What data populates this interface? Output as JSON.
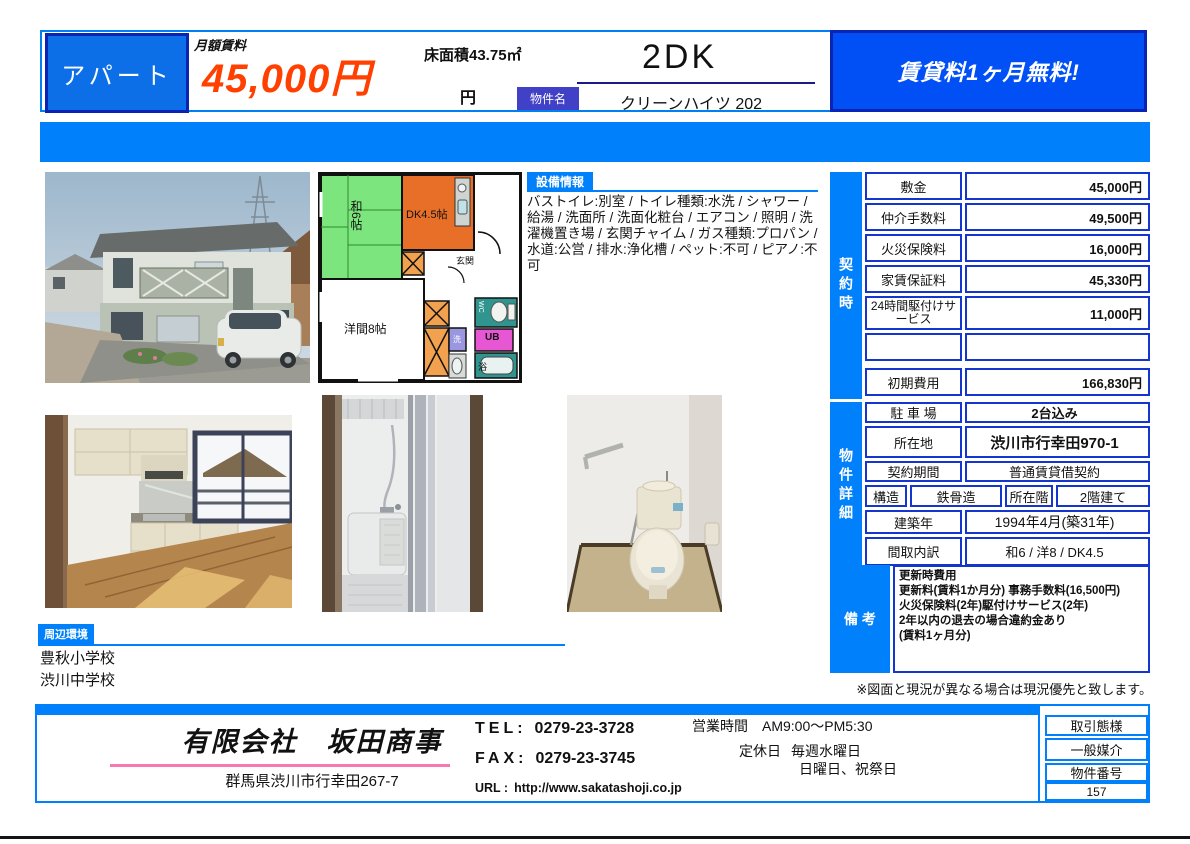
{
  "header": {
    "property_type": "アパート",
    "rent_label": "月額賃料",
    "rent_value": "45,000円",
    "floor_area": "床面積43.75㎡",
    "yen": "円",
    "layout": "2DK",
    "name_label": "物件名",
    "property_name": "クリーンハイツ 202",
    "promo": "賃貸料1ヶ月無料!"
  },
  "equipment": {
    "tab": "設備情報",
    "text": "バストイレ:別室 / トイレ種類:水洗 / シャワー / 給湯 / 洗面所 / 洗面化粧台 / エアコン / 照明 / 洗濯機置き場 / 玄関チャイム / ガス種類:プロパン / 水道:公営 / 排水:浄化槽 / ペット:不可 / ピアノ:不可"
  },
  "contract": {
    "side_label": "契約時",
    "rows": [
      {
        "label": "敷金",
        "value": "45,000円"
      },
      {
        "label": "仲介手数料",
        "value": "49,500円"
      },
      {
        "label": "火災保険料",
        "value": "16,000円"
      },
      {
        "label": "家賃保証料",
        "value": "45,330円"
      },
      {
        "label": "24時間駆付けサービス",
        "value": "11,000円"
      },
      {
        "label": "",
        "value": ""
      },
      {
        "label": "初期費用",
        "value": "166,830円"
      }
    ]
  },
  "details": {
    "side_label": "物件詳細",
    "parking_label": "駐 車 場",
    "parking": "2台込み",
    "location_label": "所在地",
    "location": "渋川市行幸田970-1",
    "term_label": "契約期間",
    "term": "普通賃貸借契約",
    "structure_label": "構造",
    "structure": "鉄骨造",
    "floor_label": "所在階",
    "floor": "2階建て",
    "built_label": "建築年",
    "built": "1994年4月(築31年)",
    "layout_label": "間取内訳",
    "layout": "和6 / 洋8 / DK4.5"
  },
  "remarks": {
    "side_label": "備 考",
    "lines": [
      "更新時費用",
      "更新料(賃料1か月分) 事務手数料(16,500円)",
      "火災保険料(2年)駆付けサービス(2年)",
      "2年以内の退去の場合違約金あり",
      " (賃料1ヶ月分)"
    ]
  },
  "note": "※図面と現況が異なる場合は現況優先と致します。",
  "surroundings": {
    "tab": "周辺環境",
    "items": [
      "豊秋小学校",
      "渋川中学校"
    ]
  },
  "floor_plan": {
    "room_tatami": "和6帖",
    "room_dk": "DK4.5帖",
    "room_west": "洋間8帖",
    "entrance": "玄関",
    "wc": "WC",
    "ub": "UB",
    "bath": "浴",
    "laundry": "洗"
  },
  "footer": {
    "company": "有限会社　坂田商事",
    "address": "群馬県渋川市行幸田267-7",
    "tel_label": "TEL:",
    "tel": "0279-23-3728",
    "fax_label": "FAX:",
    "fax": "0279-23-3745",
    "url_label": "URL :",
    "url": "http://www.sakatashoji.co.jp",
    "hours_label": "営業時間",
    "hours": "AM9:00〜PM5:30",
    "holiday_label": "定休日",
    "holiday1": "毎週水曜日",
    "holiday2": "日曜日、祝祭日",
    "deal_type_label": "取引態様",
    "deal_type": "一般媒介",
    "property_no_label": "物件番号",
    "property_no": "157"
  },
  "colors": {
    "main_blue": "#0080fa",
    "navy_border": "#0a23b4",
    "table_border": "#1535cf",
    "price_orange": "#ff4000",
    "pink_line": "#f878b4"
  }
}
